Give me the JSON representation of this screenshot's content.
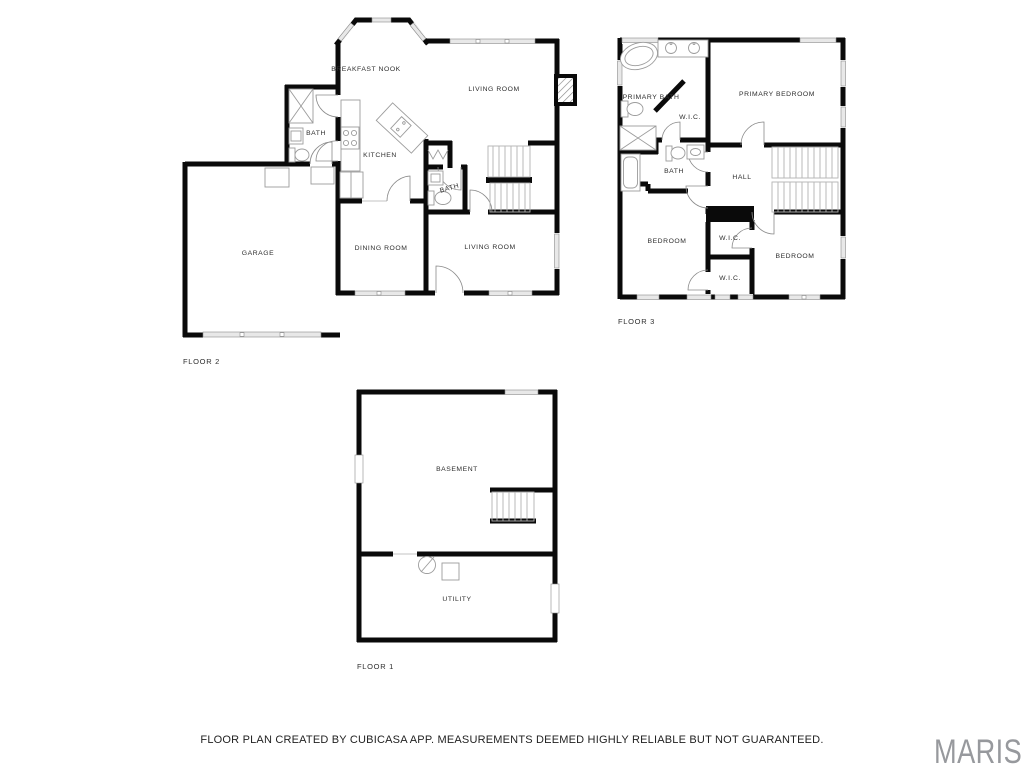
{
  "page": {
    "footer_text": "FLOOR PLAN CREATED BY CUBICASA APP. MEASUREMENTS DEEMED HIGHLY RELIABLE BUT NOT GUARANTEED.",
    "watermark": "MARIS"
  },
  "colors": {
    "background": "#ffffff",
    "wall": "#0a0a0a",
    "window_fill": "#e8e8e8",
    "window_stroke": "#8a8a8a",
    "fixture": "#9c9c9c",
    "stair": "#b3b3b3",
    "door": "#8a8a8a",
    "label": "#2e2e2e",
    "footer": "#1f1f1f",
    "watermark": "#97999d"
  },
  "floor2": {
    "label": "FLOOR 2",
    "rooms": {
      "breakfast_nook": "BREAKFAST NOOK",
      "living_room_upper": "LIVING ROOM",
      "bath_left": "BATH",
      "kitchen": "KITCHEN",
      "bath_small": "BATH",
      "garage": "GARAGE",
      "dining_room": "DINING ROOM",
      "living_room_lower": "LIVING ROOM"
    }
  },
  "floor3": {
    "label": "FLOOR 3",
    "rooms": {
      "primary_bath": "PRIMARY BATH",
      "primary_bedroom": "PRIMARY BEDROOM",
      "wic_primary": "W.I.C.",
      "bath": "BATH",
      "hall": "HALL",
      "bedroom_left": "BEDROOM",
      "wic_upper": "W.I.C.",
      "wic_lower": "W.I.C.",
      "bedroom_right": "BEDROOM"
    }
  },
  "floor1": {
    "label": "FLOOR 1",
    "rooms": {
      "basement": "BASEMENT",
      "utility": "UTILITY"
    }
  }
}
